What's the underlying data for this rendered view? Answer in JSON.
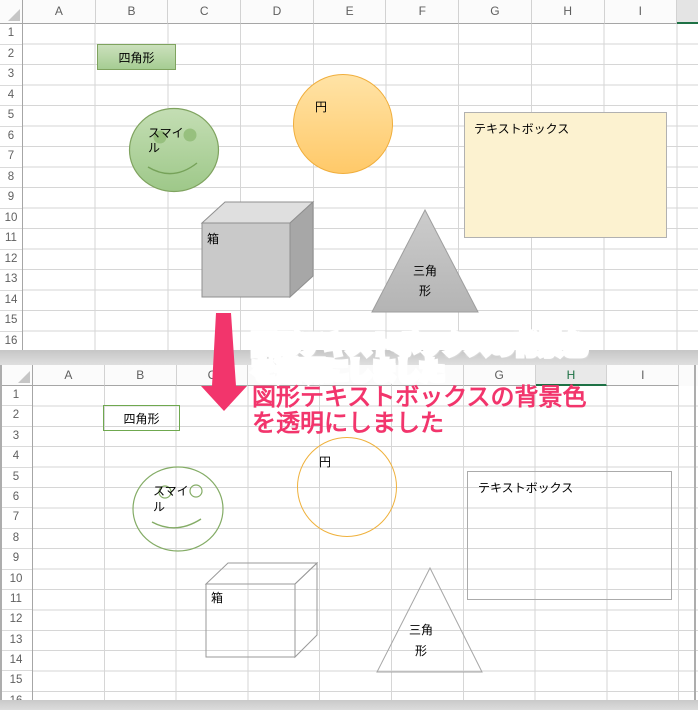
{
  "annotation": {
    "text": "図形テキストボックスの背景色\nを透明にしました"
  },
  "colors": {
    "annotation_pink": "#F2356C",
    "arrow_pink": "#F2356C",
    "selected_header_green": "#1E7145",
    "shape_green_fill": "#AED194",
    "shape_green_border": "#7FA35F",
    "shape_orange_fill": "#FFD27E",
    "shape_orange_border": "#F0AE3C",
    "textbox_fill": "#FCF2D0",
    "shape_gray_fill": "#C6C6C6"
  },
  "sheet_top": {
    "columns": [
      "A",
      "B",
      "C",
      "D",
      "E",
      "F",
      "G",
      "H",
      "I"
    ],
    "rows": [
      "1",
      "2",
      "3",
      "4",
      "5",
      "6",
      "7",
      "8",
      "9",
      "10",
      "11",
      "12",
      "13",
      "14",
      "15",
      "16"
    ],
    "shapes": {
      "rectangle": {
        "label": "四角形"
      },
      "smiley": {
        "label": "スマイ\nル"
      },
      "circle": {
        "label": "円"
      },
      "textbox": {
        "label": "テキストボックス"
      },
      "cube": {
        "label": "箱"
      },
      "triangle": {
        "label": "三角\n形"
      }
    }
  },
  "sheet_bottom": {
    "columns": [
      "A",
      "B",
      "C",
      "D",
      "E",
      "F",
      "G",
      "H",
      "I"
    ],
    "rows": [
      "1",
      "2",
      "3",
      "4",
      "5",
      "6",
      "7",
      "8",
      "9",
      "10",
      "11",
      "12",
      "13",
      "14",
      "15",
      "16"
    ],
    "selected_column": "H",
    "shapes": {
      "rectangle": {
        "label": "四角形"
      },
      "smiley": {
        "label": "スマイ\nル"
      },
      "circle": {
        "label": "円"
      },
      "textbox": {
        "label": "テキストボックス"
      },
      "cube": {
        "label": "箱"
      },
      "triangle": {
        "label": "三角\n形"
      }
    }
  }
}
